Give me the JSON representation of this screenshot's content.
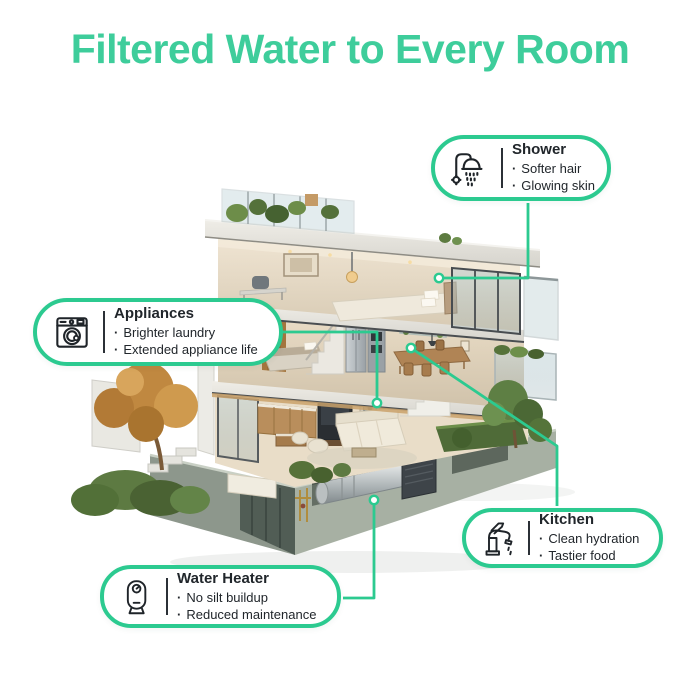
{
  "title": {
    "text": "Filtered Water to Every Room"
  },
  "theme": {
    "accent": "#2cca90",
    "title_color": "#3ecd9b",
    "text_color": "#21262b",
    "card_bg": "#ffffff",
    "bullet": "·"
  },
  "illustration": {
    "name": "three-story-house-cutaway"
  },
  "callouts": {
    "shower": {
      "icon": "shower-icon",
      "title": "Shower",
      "bullets": [
        "Softer hair",
        "Glowing skin"
      ]
    },
    "appliances": {
      "icon": "washing-machine-icon",
      "title": "Appliances",
      "bullets": [
        "Brighter laundry",
        "Extended appliance life"
      ]
    },
    "kitchen": {
      "icon": "faucet-icon",
      "title": "Kitchen",
      "bullets": [
        "Clean hydration",
        "Tastier food"
      ]
    },
    "water_heater": {
      "icon": "water-heater-icon",
      "title": "Water Heater",
      "bullets": [
        "No silt buildup",
        "Reduced maintenance"
      ]
    }
  }
}
